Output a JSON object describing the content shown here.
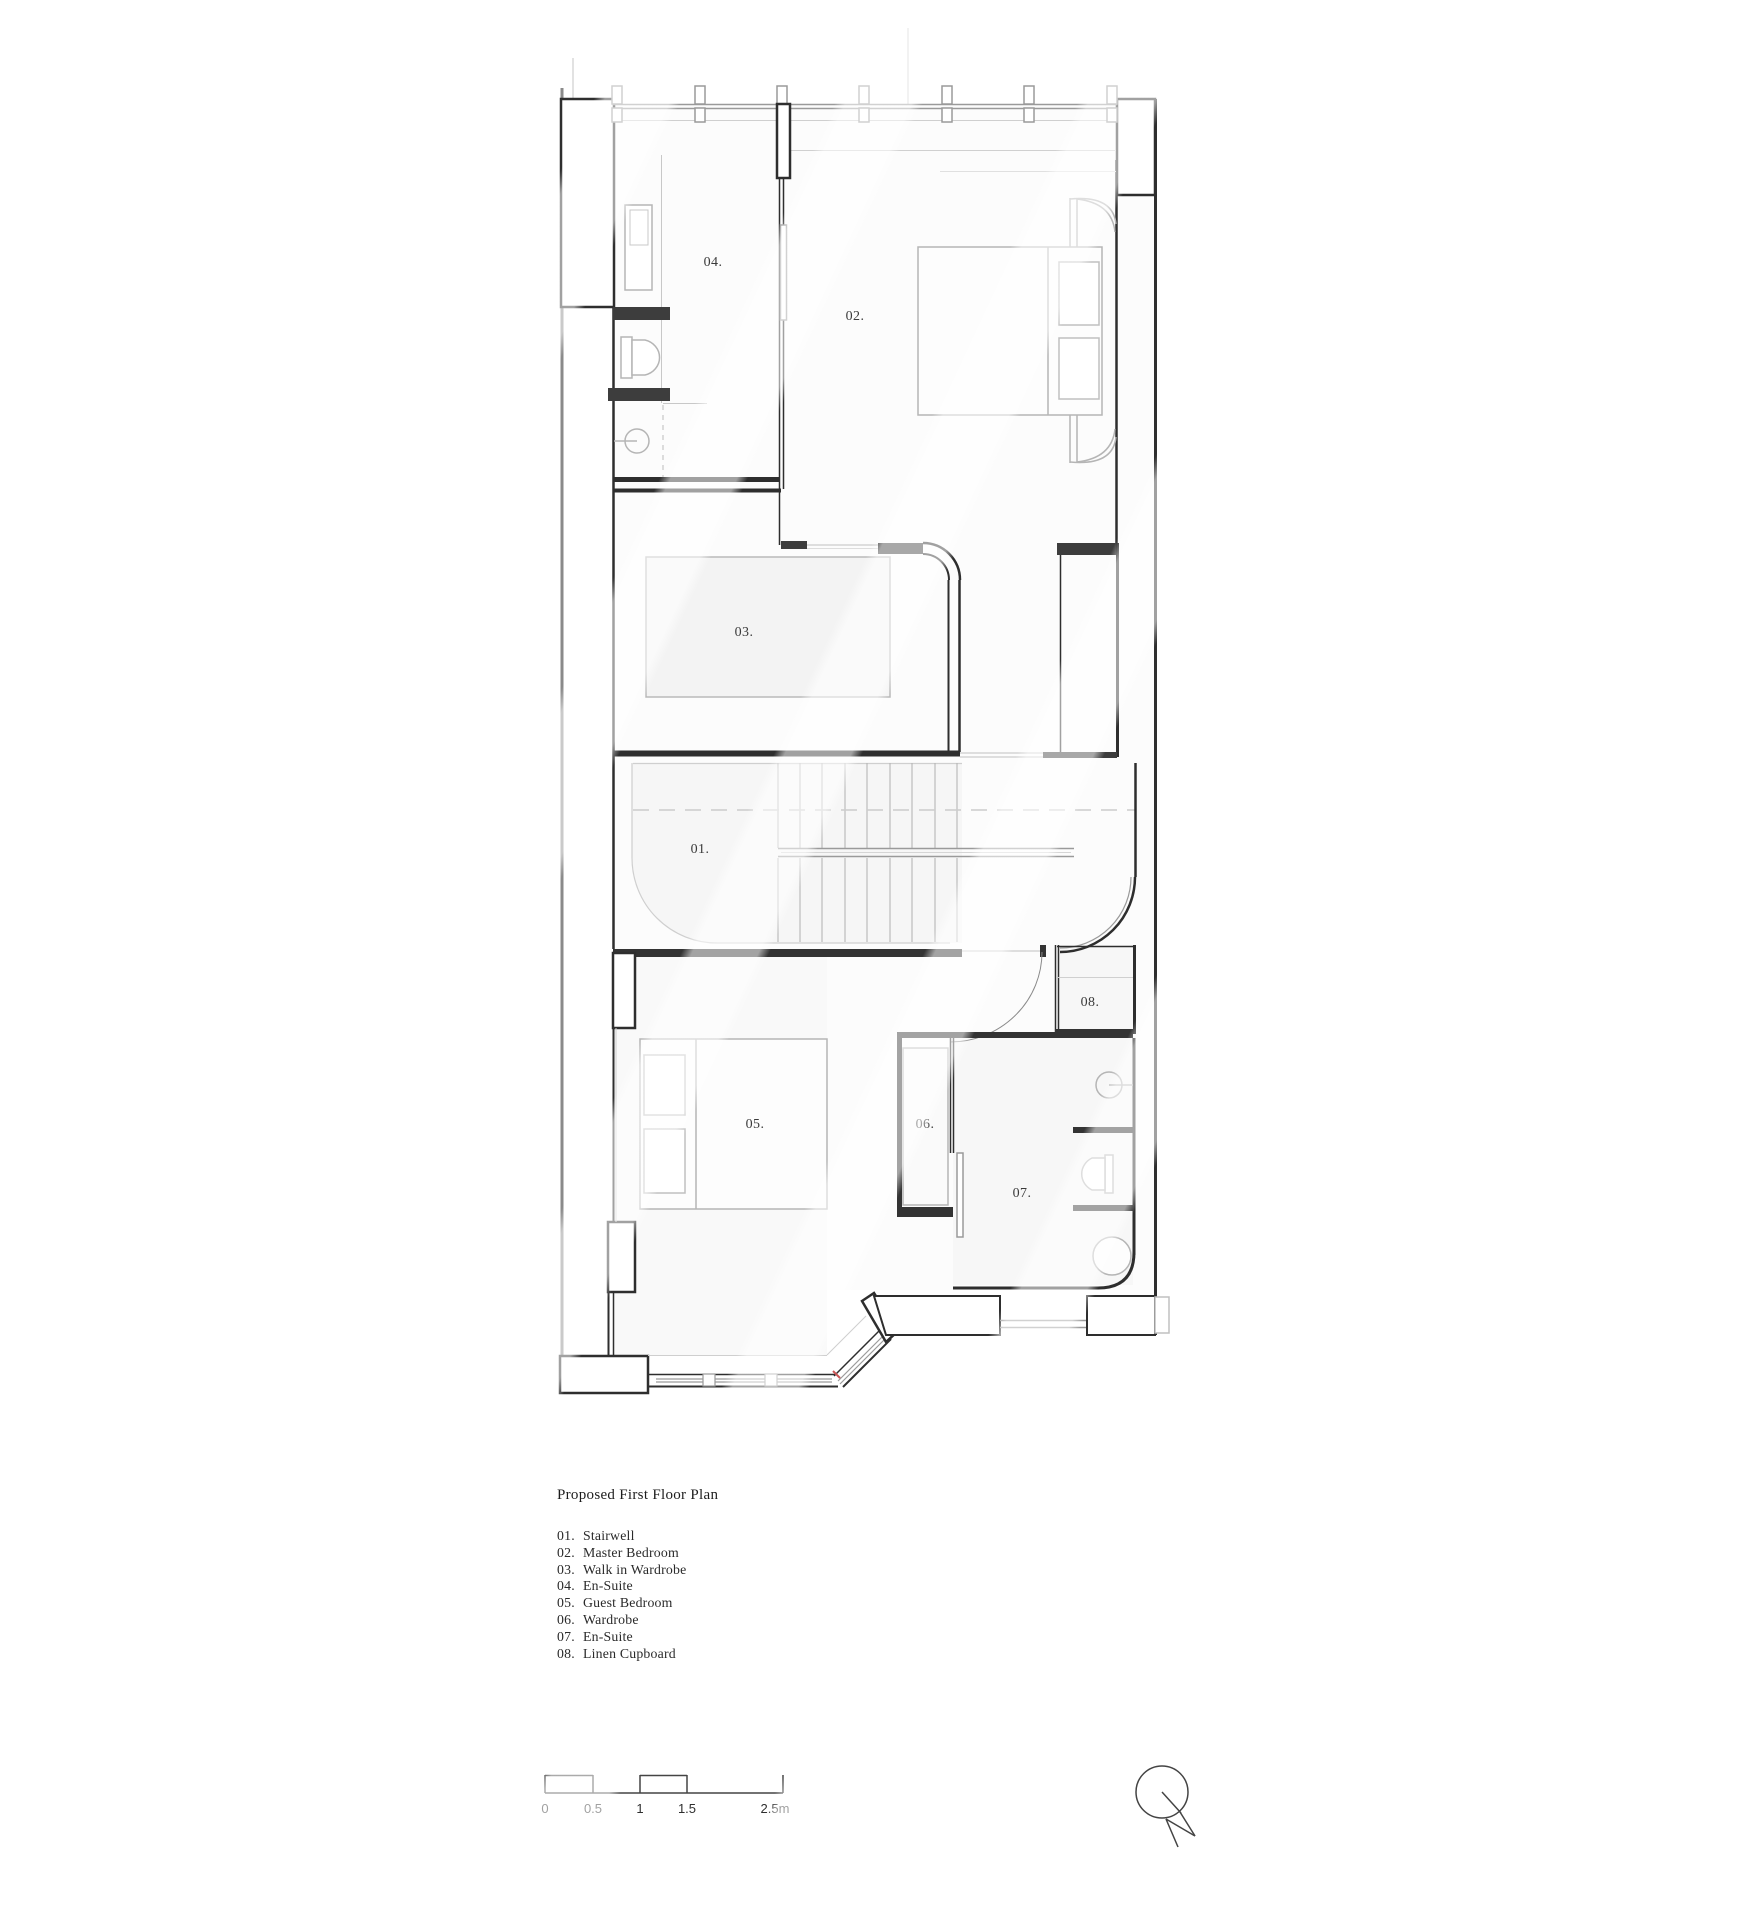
{
  "title_block": {
    "title": "Proposed First Floor Plan"
  },
  "legend": {
    "items": [
      {
        "number": "01.",
        "name": "Stairwell"
      },
      {
        "number": "02.",
        "name": "Master Bedroom"
      },
      {
        "number": "03.",
        "name": "Walk in Wardrobe"
      },
      {
        "number": "04.",
        "name": "En-Suite"
      },
      {
        "number": "05.",
        "name": "Guest Bedroom"
      },
      {
        "number": "06.",
        "name": "Wardrobe"
      },
      {
        "number": "07.",
        "name": "En-Suite"
      },
      {
        "number": "08.",
        "name": "Linen Cupboard"
      }
    ]
  },
  "rooms": [
    {
      "number": "01.",
      "name": "Stairwell"
    },
    {
      "number": "02.",
      "name": "Master Bedroom"
    },
    {
      "number": "03.",
      "name": "Walk in Wardrobe"
    },
    {
      "number": "04.",
      "name": "En-Suite"
    },
    {
      "number": "05.",
      "name": "Guest Bedroom"
    },
    {
      "number": "06.",
      "name": "Wardrobe"
    },
    {
      "number": "07.",
      "name": "En-Suite"
    },
    {
      "number": "08.",
      "name": "Linen Cupboard"
    }
  ],
  "scale_bar": {
    "labels": [
      "0",
      "0.5",
      "1",
      "1.5",
      "2.5m"
    ]
  },
  "north_arrow": {
    "label": "N"
  },
  "colors": {
    "wall": "#2e2e2e",
    "wall_solid": "#3d3d3d",
    "party_wall": "#8a8a8a",
    "fixture": "#b5b5b5",
    "faint": "#d5d5d5",
    "tint": "#f6f6f6",
    "accent_red": "#cc5555"
  }
}
